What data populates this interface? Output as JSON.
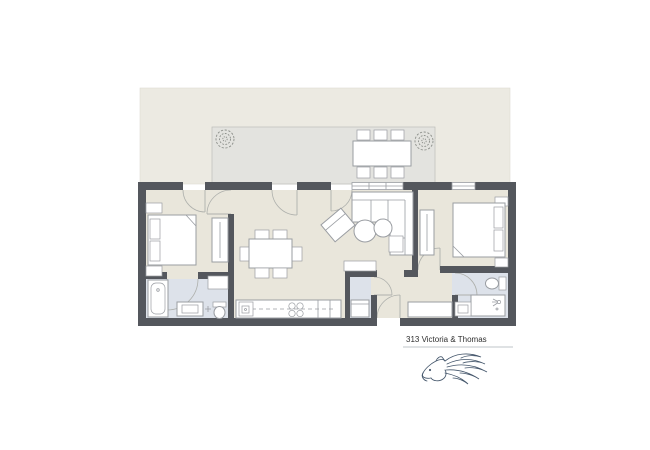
{
  "title": {
    "label": "313 Victoria & Thomas"
  },
  "logo": {
    "name": "horse-flourish-logo"
  },
  "colors": {
    "background": "#ffffff",
    "wall": "#54575d",
    "floor": "#e9e6db",
    "terrace": "#eceae2",
    "patio": "#e3e3df",
    "bath_floor": "#dde2ea",
    "furniture_fill": "#ffffff",
    "furniture_stroke": "#9a9da2",
    "door_arc": "#aeb0ac",
    "divider_line": "#aab0b8",
    "title_text": "#2f2f2f",
    "logo_stroke": "#44566b"
  }
}
